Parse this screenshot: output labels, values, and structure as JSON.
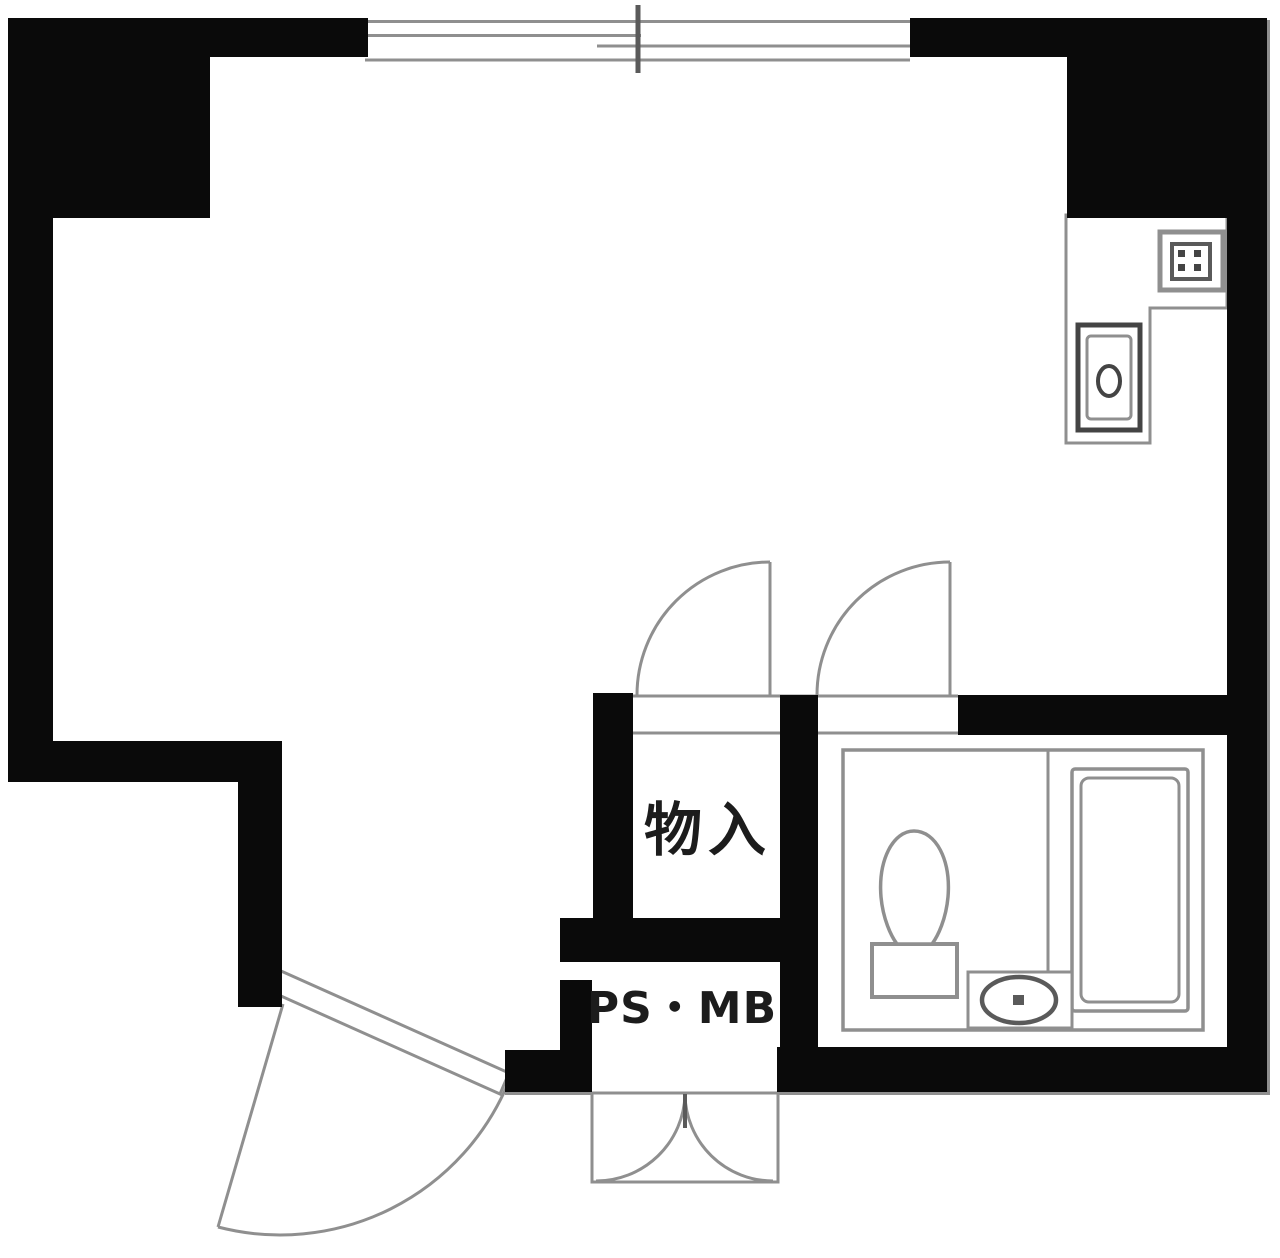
{
  "floorplan": {
    "labels": {
      "closet": "物入",
      "pipe_space_mailbox": "PS・MB"
    },
    "colors": {
      "wall": "#0a0a0a",
      "line": "#8f8f8f",
      "line_dark": "#5a5a5a",
      "fixture": "#444444",
      "text": "#1c1c1c",
      "background": "#ffffff"
    },
    "icons": [
      "sliding-window-icon",
      "stove-icon",
      "kitchen-sink-icon",
      "toilet-icon",
      "washbasin-icon",
      "bathtub-icon",
      "door-swing-arc-icon",
      "double-door-arc-icon"
    ]
  }
}
